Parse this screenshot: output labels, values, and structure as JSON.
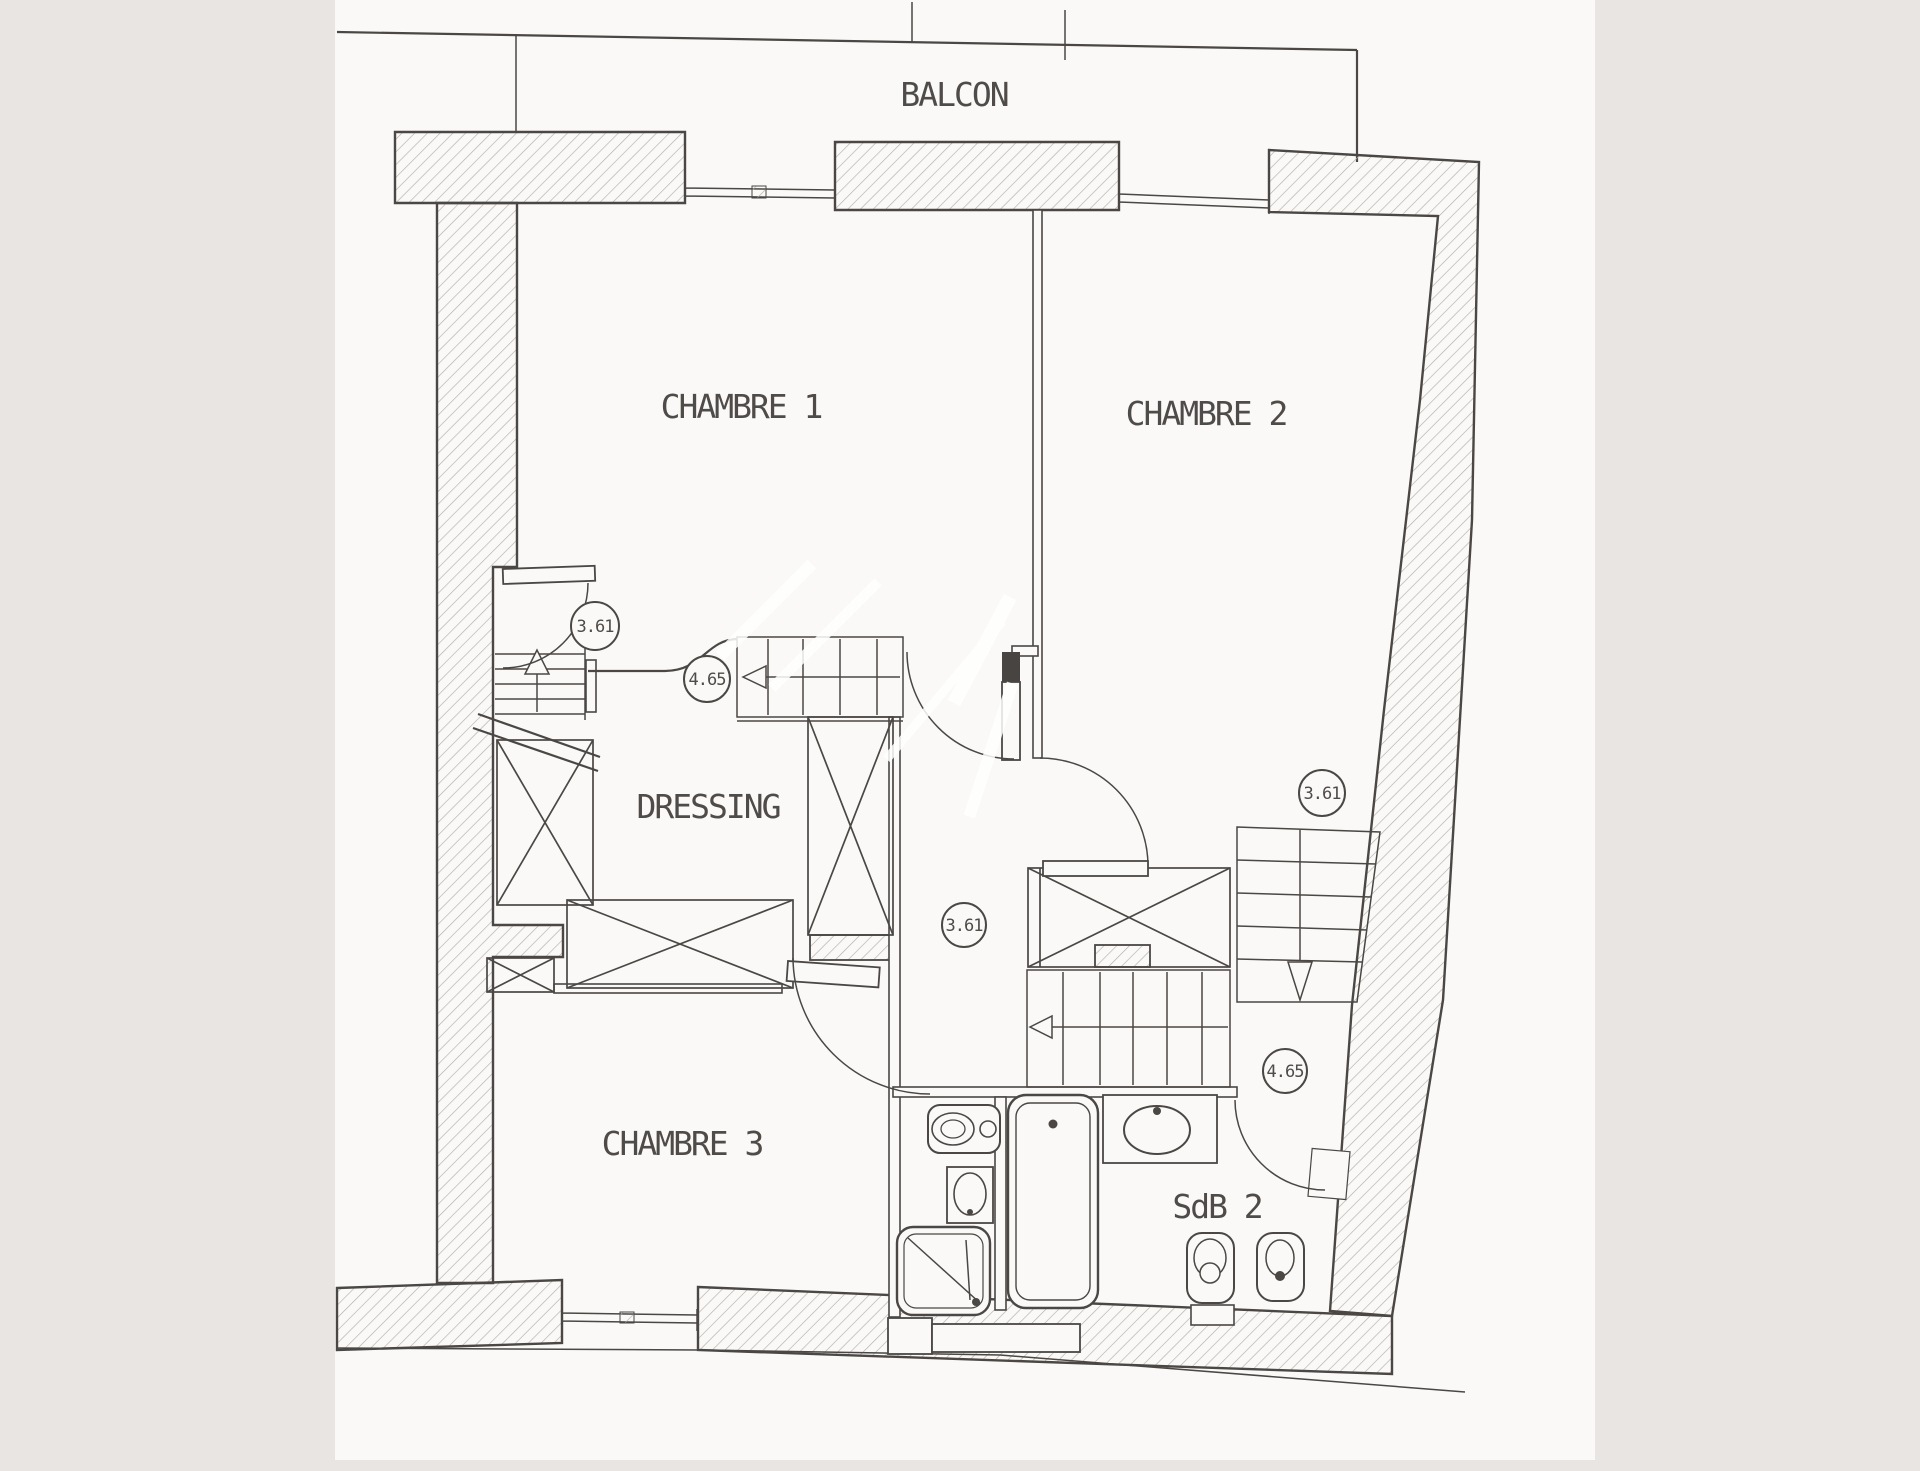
{
  "page": {
    "background_color": "#e8e5e2",
    "paper_color": "#faf9f7",
    "ink_color": "#4a4744",
    "hatch_color": "#b3afaa"
  },
  "plan": {
    "balcony_label": "BALCON",
    "rooms": [
      {
        "id": "chambre-1",
        "label": "CHAMBRE 1"
      },
      {
        "id": "chambre-2",
        "label": "CHAMBRE 2"
      },
      {
        "id": "chambre-3",
        "label": "CHAMBRE 3"
      },
      {
        "id": "dressing",
        "label": "DRESSING"
      },
      {
        "id": "sdb-2",
        "label": "SdB 2"
      }
    ],
    "dimensions": [
      {
        "value": "3.61",
        "location": "upper-landing"
      },
      {
        "value": "4.65",
        "location": "upper-stairs"
      },
      {
        "value": "3.61",
        "location": "central-hall"
      },
      {
        "value": "3.61",
        "location": "chambre-2-corner"
      },
      {
        "value": "4.65",
        "location": "lower-stairs"
      }
    ]
  }
}
